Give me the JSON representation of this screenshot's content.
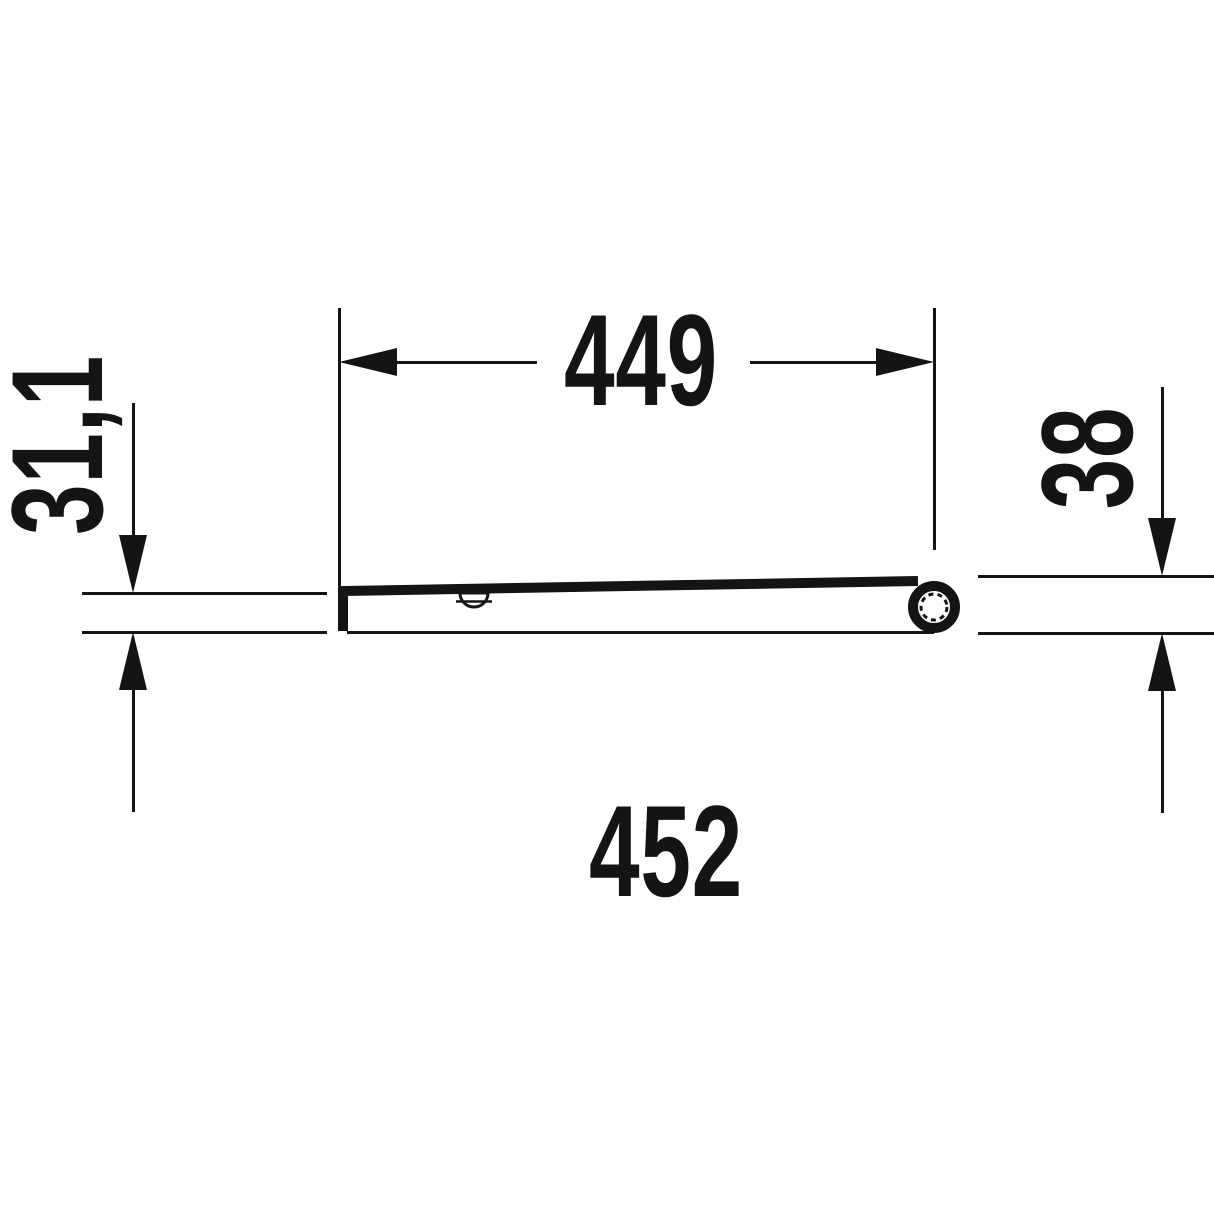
{
  "drawing": {
    "type": "technical-dimension-side-profile",
    "colors": {
      "ink": "#141414",
      "background": "#ffffff"
    },
    "dimensions": {
      "hinge_distance": {
        "label": "449"
      },
      "front_thickness": {
        "label": "31,1"
      },
      "rear_thickness": {
        "label": "38"
      },
      "overall_depth": {
        "label": "452"
      }
    }
  }
}
